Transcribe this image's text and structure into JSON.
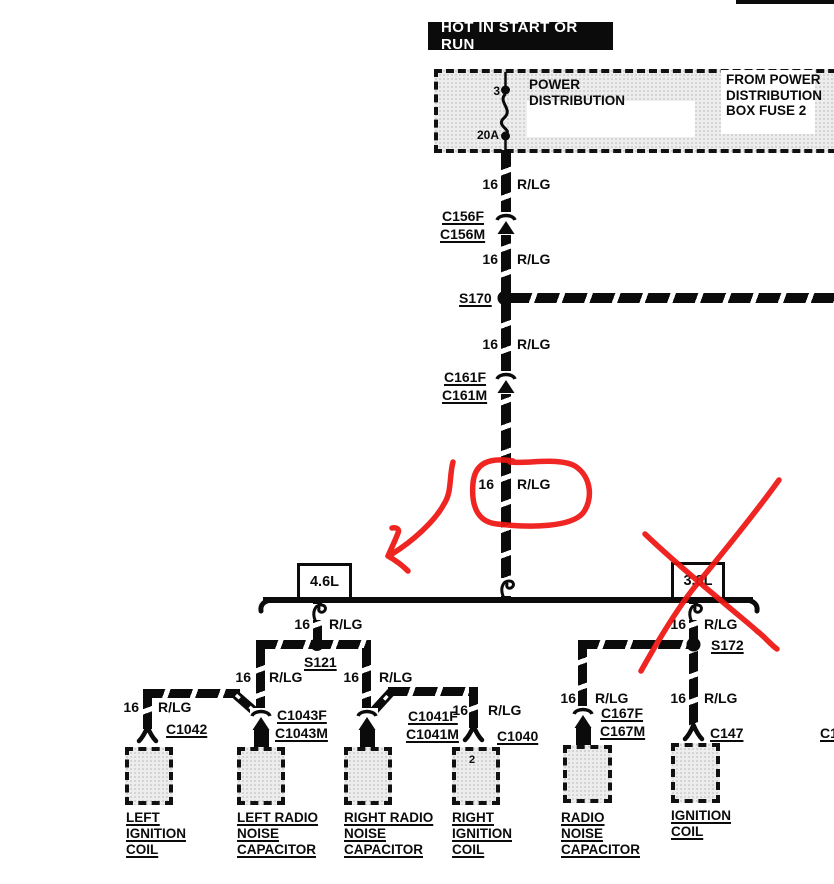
{
  "banner": {
    "text": "HOT IN START OR RUN"
  },
  "power_box": {
    "title_l1": "POWER",
    "title_l2": "DISTRIBUTION",
    "source_l1": "FROM POWER",
    "source_l2": "DISTRIBUTION",
    "source_l3": "BOX FUSE 2",
    "fuse_pin": "3",
    "fuse_rating": "20A"
  },
  "wire_label": {
    "gauge": "16",
    "color": "R/LG"
  },
  "connectors": {
    "c156f": "C156F",
    "c156m": "C156M",
    "s170": "S170",
    "c161f": "C161F",
    "c161m": "C161M",
    "s121": "S121",
    "c1042": "C1042",
    "c1043f": "C1043F",
    "c1043m": "C1043M",
    "c1041f": "C1041F",
    "c1041m": "C1041M",
    "c1040": "C1040",
    "s172": "S172",
    "c167f": "C167F",
    "c167m": "C167M",
    "c147": "C147"
  },
  "engine": {
    "left_label": "4.6L",
    "right_label": "3.8L"
  },
  "pins": {
    "c1040_pin2": "2"
  },
  "edge": {
    "partial_connector": "C1"
  },
  "components": {
    "c1": {
      "l1": "LEFT",
      "l2": "IGNITION",
      "l3": "COIL"
    },
    "c2": {
      "l1": "LEFT RADIO",
      "l2": "NOISE",
      "l3": "CAPACITOR"
    },
    "c3": {
      "l1": "RIGHT RADIO",
      "l2": "NOISE",
      "l3": "CAPACITOR"
    },
    "c4": {
      "l1": "RIGHT",
      "l2": "IGNITION",
      "l3": "COIL"
    },
    "c5": {
      "l1": "RADIO",
      "l2": "NOISE",
      "l3": "CAPACITOR"
    },
    "c6": {
      "l1": "IGNITION",
      "l2": "COIL"
    }
  },
  "colors": {
    "annotation_red": "#ee1512",
    "diagram_black": "#0b0b0b",
    "box_fill": "#ededed"
  }
}
